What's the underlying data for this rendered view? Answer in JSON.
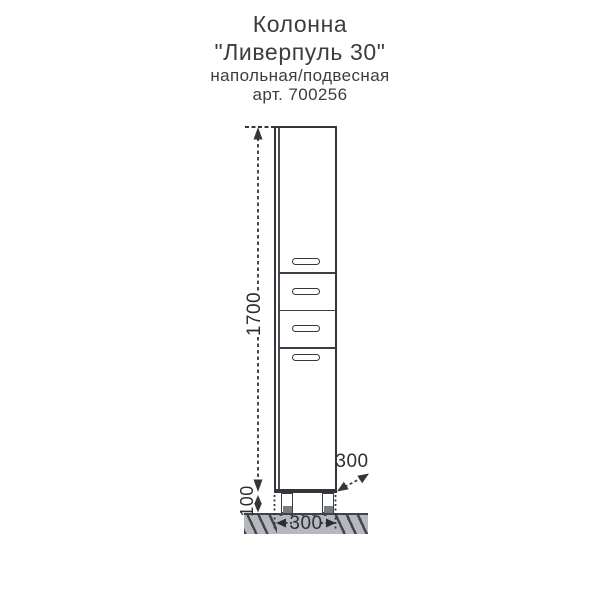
{
  "title": {
    "product": "Колонна",
    "model": "\"Ливерпуль 30\"",
    "mounting": "напольная/подвесная",
    "article": "арт. 700256"
  },
  "dimensions": {
    "height_mm": "1700",
    "leg_height_mm": "100",
    "width_mm": "300",
    "depth_mm": "300"
  },
  "drawing": {
    "sections": [
      "door-top",
      "drawer-1",
      "drawer-2",
      "door-bottom"
    ],
    "handle_count": 4,
    "leg_count": 2
  },
  "colors": {
    "line": "#33363a",
    "floor_fill": "#b5b9bd",
    "hatch": "#42464c",
    "leg_foot": "#787e84",
    "title_text": "#3d3d3d",
    "dimension_text": "#2b2f34"
  }
}
